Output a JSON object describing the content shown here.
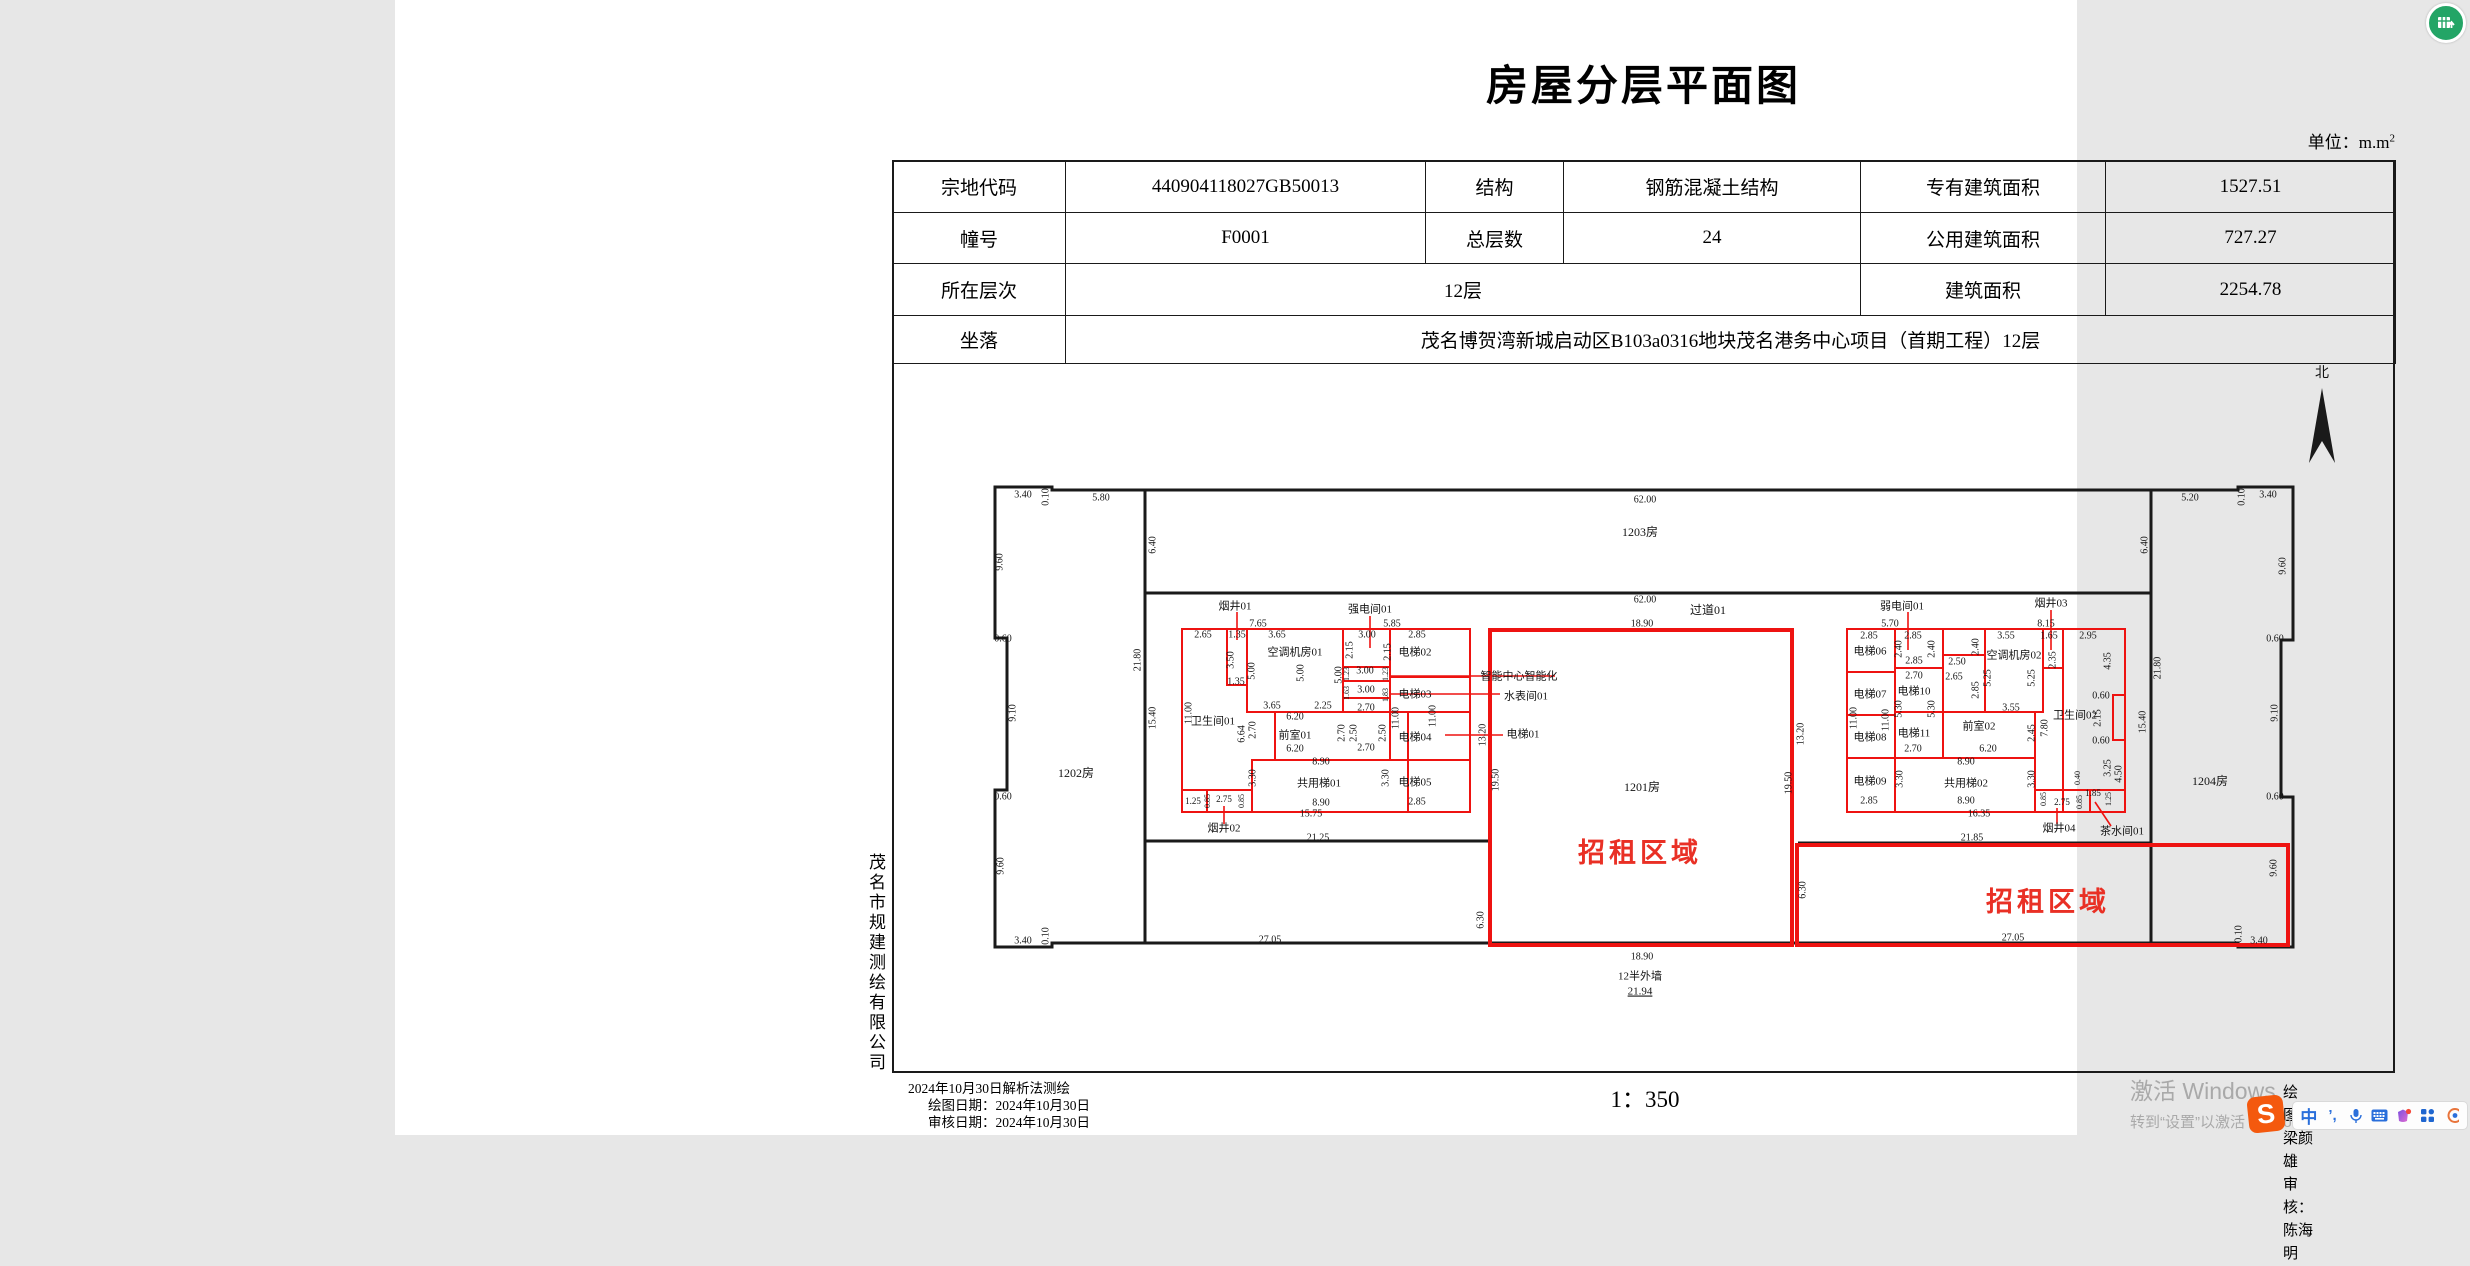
{
  "page": {
    "title": "房屋分层平面图",
    "unit_prefix": "单位：m.m",
    "unit_sup": "2"
  },
  "info_table": {
    "r1c1": "宗地代码",
    "r1c2": "440904118027GB50013",
    "r1c3": "结构",
    "r1c4": "钢筋混凝土结构",
    "r1c5": "专有建筑面积",
    "r1c6": "1527.51",
    "r2c1": "幢号",
    "r2c2": "F0001",
    "r2c3": "总层数",
    "r2c4": "24",
    "r2c5": "公用建筑面积",
    "r2c6": "727.27",
    "r3c1": "所在层次",
    "r3c2": "12层",
    "r3c5": "建筑面积",
    "r3c6": "2254.78",
    "r4c1": "坐落",
    "r4c2": "茂名博贺湾新城启动区B103a0316地块茂名港务中心项目（首期工程）12层"
  },
  "company": "茂名市规建测绘有限公司",
  "footer": {
    "line1": "2024年10月30日解析法测绘",
    "line2": "绘图日期：2024年10月30日",
    "line3": "审核日期：2024年10月30日",
    "scale": "1：350",
    "drafter": "绘图：梁颜雄",
    "checker": "审核：陈海明"
  },
  "watermark": {
    "line1": "激活 Windows",
    "line2": "转到“设置”以激活 Windows。"
  },
  "ime": {
    "sogou": "S",
    "mode": "中",
    "punct": "’,"
  },
  "plan": {
    "colors": {
      "wall": "#1a1a1a",
      "red": "#ee1311",
      "text": "#141414",
      "red_text": "#e93025"
    },
    "north_label": "北",
    "north_arrow_points": "1927,388 1914,463 1927,441 1940,463",
    "north_label_pos": [
      1927,
      377
    ],
    "walls": [
      "M657,490 L657,487 L600,487 L600,638 L612,638 L612,790 L600,790 L600,947 L657,947 L657,943 L1843,943 L1843,947 L1898,947 L1898,797 L1886,797 L1886,640 L1898,640 L1898,487 L1843,487 L1843,490 Z",
      "M750,490 L750,943",
      "M1756,490 L1756,943",
      "M750,593 L1756,593",
      "M750,841 L1093,841",
      "M1403,843 L1756,843"
    ],
    "black_lines": [
      [
        995,
        677,
        1075,
        677
      ],
      [
        1013,
        760,
        1075,
        760
      ],
      [
        1452,
        672,
        1500,
        672
      ],
      [
        1452,
        715,
        1500,
        715
      ],
      [
        1452,
        758,
        1500,
        758
      ],
      [
        1500,
        712,
        1548,
        712
      ]
    ],
    "red_rects": [
      {
        "x": 787,
        "y": 629,
        "w": 288,
        "h": 183
      },
      {
        "x": 832,
        "y": 629,
        "w": 20,
        "h": 56
      },
      {
        "x": 852,
        "y": 629,
        "w": 96,
        "h": 83
      },
      {
        "x": 948,
        "y": 629,
        "w": 47,
        "h": 38
      },
      {
        "x": 948,
        "y": 667,
        "w": 47,
        "h": 14
      },
      {
        "x": 948,
        "y": 681,
        "w": 47,
        "h": 17
      },
      {
        "x": 995,
        "y": 629,
        "w": 80,
        "h": 48
      },
      {
        "x": 995,
        "y": 677,
        "w": 80,
        "h": 35
      },
      {
        "x": 995,
        "y": 712,
        "w": 80,
        "h": 48
      },
      {
        "x": 880,
        "y": 712,
        "w": 133,
        "h": 48
      },
      {
        "x": 857,
        "y": 760,
        "w": 156,
        "h": 52
      },
      {
        "x": 1013,
        "y": 760,
        "w": 62,
        "h": 52
      },
      {
        "x": 787,
        "y": 790,
        "w": 25,
        "h": 22
      },
      {
        "x": 812,
        "y": 790,
        "w": 45,
        "h": 22
      },
      {
        "x": 1452,
        "y": 629,
        "w": 278,
        "h": 183
      },
      {
        "x": 1452,
        "y": 629,
        "w": 48,
        "h": 43
      },
      {
        "x": 1452,
        "y": 672,
        "w": 48,
        "h": 43
      },
      {
        "x": 1452,
        "y": 715,
        "w": 48,
        "h": 43
      },
      {
        "x": 1452,
        "y": 758,
        "w": 48,
        "h": 54
      },
      {
        "x": 1500,
        "y": 629,
        "w": 48,
        "h": 39
      },
      {
        "x": 1500,
        "y": 668,
        "w": 48,
        "h": 44
      },
      {
        "x": 1500,
        "y": 712,
        "w": 48,
        "h": 46
      },
      {
        "x": 1548,
        "y": 655,
        "w": 42,
        "h": 57
      },
      {
        "x": 1590,
        "y": 629,
        "w": 58,
        "h": 83
      },
      {
        "x": 1648,
        "y": 629,
        "w": 20,
        "h": 39
      },
      {
        "x": 1548,
        "y": 712,
        "w": 92,
        "h": 46
      },
      {
        "x": 1500,
        "y": 758,
        "w": 140,
        "h": 54
      },
      {
        "x": 1640,
        "y": 790,
        "w": 55,
        "h": 22
      },
      {
        "x": 1695,
        "y": 790,
        "w": 35,
        "h": 22
      },
      {
        "x": 1095,
        "y": 630,
        "w": 302,
        "h": 315,
        "thick": 1
      },
      {
        "x": 1402,
        "y": 845,
        "w": 491,
        "h": 100,
        "thick": 1
      }
    ],
    "red_paths": [
      "M1668,629 L1730,629 L1730,695 L1718,695 L1718,740 L1730,740 L1730,812 L1668,812 Z"
    ],
    "red_lines": [
      [
        842,
        612,
        842,
        640
      ],
      [
        975,
        616,
        975,
        648
      ],
      [
        1513,
        612,
        1513,
        650
      ],
      [
        1656,
        610,
        1656,
        650
      ],
      [
        829,
        824,
        829,
        806
      ],
      [
        1662,
        824,
        1662,
        808
      ],
      [
        1716,
        826,
        1700,
        802
      ],
      [
        995,
        676,
        1160,
        676
      ],
      [
        995,
        694,
        1105,
        694
      ],
      [
        1050,
        735,
        1108,
        735
      ]
    ],
    "labels": [
      {
        "t": "3.40",
        "x": 628,
        "y": 495
      },
      {
        "t": "0.10",
        "x": 651,
        "y": 497,
        "v": 1
      },
      {
        "t": "5.80",
        "x": 706,
        "y": 498
      },
      {
        "t": "62.00",
        "x": 1250,
        "y": 500
      },
      {
        "t": "5.20",
        "x": 1795,
        "y": 498
      },
      {
        "t": "0.10",
        "x": 1847,
        "y": 497,
        "v": 1
      },
      {
        "t": "3.40",
        "x": 1873,
        "y": 495
      },
      {
        "t": "6.40",
        "x": 758,
        "y": 545,
        "v": 1
      },
      {
        "t": "6.40",
        "x": 1750,
        "y": 545,
        "v": 1
      },
      {
        "t": "1203房",
        "x": 1245,
        "y": 533,
        "s": 12
      },
      {
        "t": "62.00",
        "x": 1250,
        "y": 600
      },
      {
        "t": "过道01",
        "x": 1313,
        "y": 611,
        "s": 12
      },
      {
        "t": "18.90",
        "x": 1247,
        "y": 624
      },
      {
        "t": "9.60",
        "x": 605,
        "y": 562,
        "v": 1
      },
      {
        "t": "0.60",
        "x": 608,
        "y": 639
      },
      {
        "t": "9.10",
        "x": 618,
        "y": 713,
        "v": 1
      },
      {
        "t": "0.60",
        "x": 608,
        "y": 797
      },
      {
        "t": "9.60",
        "x": 606,
        "y": 866,
        "v": 1
      },
      {
        "t": "9.60",
        "x": 1888,
        "y": 566,
        "v": 1
      },
      {
        "t": "0.60",
        "x": 1880,
        "y": 639
      },
      {
        "t": "9.10",
        "x": 1880,
        "y": 713,
        "v": 1
      },
      {
        "t": "0.60",
        "x": 1880,
        "y": 797
      },
      {
        "t": "9.60",
        "x": 1879,
        "y": 868,
        "v": 1
      },
      {
        "t": "21.80",
        "x": 743,
        "y": 660,
        "v": 1
      },
      {
        "t": "15.40",
        "x": 758,
        "y": 718,
        "v": 1
      },
      {
        "t": "21.80",
        "x": 1763,
        "y": 668,
        "v": 1
      },
      {
        "t": "15.40",
        "x": 1748,
        "y": 722,
        "v": 1
      },
      {
        "t": "1202房",
        "x": 681,
        "y": 774,
        "s": 12
      },
      {
        "t": "1204房",
        "x": 1815,
        "y": 782,
        "s": 12
      },
      {
        "t": "3.40",
        "x": 628,
        "y": 941
      },
      {
        "t": "0.10",
        "x": 651,
        "y": 936,
        "v": 1
      },
      {
        "t": "0.10",
        "x": 1844,
        "y": 934,
        "v": 1
      },
      {
        "t": "3.40",
        "x": 1864,
        "y": 941
      },
      {
        "t": "27.05",
        "x": 875,
        "y": 940
      },
      {
        "t": "18.90",
        "x": 1247,
        "y": 957
      },
      {
        "t": "27.05",
        "x": 1618,
        "y": 938
      },
      {
        "t": "12半外墙",
        "x": 1245,
        "y": 977,
        "s": 11
      },
      {
        "t": "21.94",
        "x": 1245,
        "y": 992,
        "s": 11,
        "u": 1
      },
      {
        "t": "6.30",
        "x": 1086,
        "y": 920,
        "v": 1
      },
      {
        "t": "6.30",
        "x": 1408,
        "y": 890,
        "v": 1
      },
      {
        "t": "19.50",
        "x": 1101,
        "y": 780,
        "v": 1
      },
      {
        "t": "19.50",
        "x": 1394,
        "y": 783,
        "v": 1
      },
      {
        "t": "13.20",
        "x": 1088,
        "y": 735,
        "v": 1
      },
      {
        "t": "13.20",
        "x": 1406,
        "y": 734,
        "v": 1
      },
      {
        "t": "1201房",
        "x": 1247,
        "y": 788,
        "s": 12
      },
      {
        "t": "招租区域",
        "x": 1245,
        "y": 856,
        "s": 27,
        "c": 1,
        "b": 1
      },
      {
        "t": "招租区域",
        "x": 1653,
        "y": 905,
        "s": 27,
        "c": 1,
        "b": 1
      },
      {
        "t": "21.25",
        "x": 923,
        "y": 838
      },
      {
        "t": "21.85",
        "x": 1577,
        "y": 838
      },
      {
        "t": "烟井01",
        "x": 840,
        "y": 607,
        "s": 11
      },
      {
        "t": "7.65",
        "x": 863,
        "y": 624
      },
      {
        "t": "强电间01",
        "x": 975,
        "y": 610,
        "s": 11
      },
      {
        "t": "5.85",
        "x": 997,
        "y": 624
      },
      {
        "t": "2.65",
        "x": 808,
        "y": 635
      },
      {
        "t": "1.35",
        "x": 842,
        "y": 635
      },
      {
        "t": "3.65",
        "x": 882,
        "y": 635
      },
      {
        "t": "3.00",
        "x": 972,
        "y": 635
      },
      {
        "t": "2.85",
        "x": 1022,
        "y": 635
      },
      {
        "t": "空调机房01",
        "x": 900,
        "y": 653,
        "s": 11
      },
      {
        "t": "电梯02",
        "x": 1020,
        "y": 653,
        "s": 11
      },
      {
        "t": "2.15",
        "x": 955,
        "y": 650,
        "v": 1
      },
      {
        "t": "2.15",
        "x": 993,
        "y": 652,
        "v": 1
      },
      {
        "t": "5.00",
        "x": 857,
        "y": 671,
        "v": 1
      },
      {
        "t": "5.00",
        "x": 906,
        "y": 673,
        "v": 1
      },
      {
        "t": "5.00",
        "x": 944,
        "y": 675,
        "v": 1
      },
      {
        "t": "3.50",
        "x": 836,
        "y": 660,
        "v": 1
      },
      {
        "t": "1.35",
        "x": 841,
        "y": 682
      },
      {
        "t": "1.23",
        "x": 952,
        "y": 674,
        "v": 1,
        "s": 8
      },
      {
        "t": "3.00",
        "x": 970,
        "y": 671
      },
      {
        "t": "1.23",
        "x": 991,
        "y": 674,
        "v": 1,
        "s": 8
      },
      {
        "t": "1.63",
        "x": 952,
        "y": 693,
        "v": 1,
        "s": 8
      },
      {
        "t": "3.00",
        "x": 971,
        "y": 690
      },
      {
        "t": "1.83",
        "x": 991,
        "y": 695,
        "v": 1,
        "s": 8
      },
      {
        "t": "2.70",
        "x": 971,
        "y": 708
      },
      {
        "t": "11.00",
        "x": 1001,
        "y": 718,
        "v": 1
      },
      {
        "t": "11.00",
        "x": 1038,
        "y": 716,
        "v": 1
      },
      {
        "t": "电梯03",
        "x": 1020,
        "y": 695,
        "s": 11
      },
      {
        "t": "电梯04",
        "x": 1020,
        "y": 738,
        "s": 11
      },
      {
        "t": "电梯05",
        "x": 1020,
        "y": 783,
        "s": 11
      },
      {
        "t": "2.85",
        "x": 1022,
        "y": 802
      },
      {
        "t": "卫生间01",
        "x": 818,
        "y": 722,
        "s": 11
      },
      {
        "t": "11.00",
        "x": 794,
        "y": 713,
        "v": 1
      },
      {
        "t": "6.64",
        "x": 847,
        "y": 734,
        "v": 1
      },
      {
        "t": "3.65",
        "x": 877,
        "y": 706
      },
      {
        "t": "2.25",
        "x": 928,
        "y": 706
      },
      {
        "t": "6.20",
        "x": 900,
        "y": 717
      },
      {
        "t": "前室01",
        "x": 900,
        "y": 736,
        "s": 11
      },
      {
        "t": "2.70",
        "x": 858,
        "y": 730,
        "v": 1
      },
      {
        "t": "2.70",
        "x": 947,
        "y": 733,
        "v": 1
      },
      {
        "t": "2.50",
        "x": 959,
        "y": 733,
        "v": 1
      },
      {
        "t": "2.50",
        "x": 988,
        "y": 733,
        "v": 1
      },
      {
        "t": "2.70",
        "x": 971,
        "y": 748
      },
      {
        "t": "6.20",
        "x": 900,
        "y": 749
      },
      {
        "t": "8.90",
        "x": 926,
        "y": 762
      },
      {
        "t": "3.30",
        "x": 858,
        "y": 778,
        "v": 1
      },
      {
        "t": "3.30",
        "x": 991,
        "y": 778,
        "v": 1
      },
      {
        "t": "共用梯01",
        "x": 924,
        "y": 784,
        "s": 11
      },
      {
        "t": "8.90",
        "x": 926,
        "y": 803
      },
      {
        "t": "15.75",
        "x": 916,
        "y": 814
      },
      {
        "t": "1.25",
        "x": 798,
        "y": 802,
        "s": 9
      },
      {
        "t": "2.75",
        "x": 829,
        "y": 800,
        "s": 9
      },
      {
        "t": "0.85",
        "x": 813,
        "y": 801,
        "v": 1,
        "s": 8
      },
      {
        "t": "0.85",
        "x": 847,
        "y": 801,
        "v": 1,
        "s": 8
      },
      {
        "t": "烟井02",
        "x": 829,
        "y": 829,
        "s": 11
      },
      {
        "t": "智能中心智能化",
        "x": 1124,
        "y": 677,
        "s": 11
      },
      {
        "t": "水表间01",
        "x": 1131,
        "y": 697,
        "s": 11
      },
      {
        "t": "电梯01",
        "x": 1128,
        "y": 735,
        "s": 11
      },
      {
        "t": "弱电间01",
        "x": 1507,
        "y": 607,
        "s": 11
      },
      {
        "t": "5.70",
        "x": 1495,
        "y": 624
      },
      {
        "t": "烟井03",
        "x": 1656,
        "y": 604,
        "s": 11
      },
      {
        "t": "8.15",
        "x": 1651,
        "y": 624
      },
      {
        "t": "2.85",
        "x": 1474,
        "y": 636
      },
      {
        "t": "2.85",
        "x": 1518,
        "y": 636
      },
      {
        "t": "3.55",
        "x": 1611,
        "y": 636
      },
      {
        "t": "1.65",
        "x": 1654,
        "y": 636
      },
      {
        "t": "2.95",
        "x": 1693,
        "y": 636
      },
      {
        "t": "电梯06",
        "x": 1475,
        "y": 652,
        "s": 11
      },
      {
        "t": "2.40",
        "x": 1504,
        "y": 649,
        "v": 1
      },
      {
        "t": "2.40",
        "x": 1537,
        "y": 649,
        "v": 1
      },
      {
        "t": "2.85",
        "x": 1519,
        "y": 661
      },
      {
        "t": "2.50",
        "x": 1562,
        "y": 662
      },
      {
        "t": "2.65",
        "x": 1559,
        "y": 677
      },
      {
        "t": "2.40",
        "x": 1581,
        "y": 647,
        "v": 1
      },
      {
        "t": "2.85",
        "x": 1581,
        "y": 690,
        "v": 1
      },
      {
        "t": "空调机房02",
        "x": 1619,
        "y": 656,
        "s": 11
      },
      {
        "t": "5.25",
        "x": 1593,
        "y": 678,
        "v": 1
      },
      {
        "t": "5.25",
        "x": 1637,
        "y": 678,
        "v": 1
      },
      {
        "t": "2.35",
        "x": 1658,
        "y": 660,
        "v": 1
      },
      {
        "t": "4.35",
        "x": 1713,
        "y": 661,
        "v": 1
      },
      {
        "t": "电梯07",
        "x": 1475,
        "y": 695,
        "s": 11
      },
      {
        "t": "2.70",
        "x": 1519,
        "y": 676
      },
      {
        "t": "电梯10",
        "x": 1519,
        "y": 692,
        "s": 11
      },
      {
        "t": "5.30",
        "x": 1504,
        "y": 709,
        "v": 1
      },
      {
        "t": "5.30",
        "x": 1537,
        "y": 709,
        "v": 1
      },
      {
        "t": "11.00",
        "x": 1459,
        "y": 718,
        "v": 1
      },
      {
        "t": "11.00",
        "x": 1491,
        "y": 720,
        "v": 1
      },
      {
        "t": "0.60",
        "x": 1706,
        "y": 696
      },
      {
        "t": "卫生间02",
        "x": 1680,
        "y": 716,
        "s": 11
      },
      {
        "t": "2.15",
        "x": 1703,
        "y": 718,
        "v": 1
      },
      {
        "t": "0.60",
        "x": 1706,
        "y": 741
      },
      {
        "t": "电梯08",
        "x": 1475,
        "y": 738,
        "s": 11
      },
      {
        "t": "电梯11",
        "x": 1519,
        "y": 734,
        "s": 11
      },
      {
        "t": "2.70",
        "x": 1518,
        "y": 749
      },
      {
        "t": "前室02",
        "x": 1584,
        "y": 727,
        "s": 11
      },
      {
        "t": "2.45",
        "x": 1637,
        "y": 733,
        "v": 1
      },
      {
        "t": "7.80",
        "x": 1650,
        "y": 728,
        "v": 1
      },
      {
        "t": "6.20",
        "x": 1593,
        "y": 749
      },
      {
        "t": "3.55",
        "x": 1616,
        "y": 708
      },
      {
        "t": "3.25",
        "x": 1713,
        "y": 768,
        "v": 1
      },
      {
        "t": "4.50",
        "x": 1724,
        "y": 774,
        "v": 1
      },
      {
        "t": "8.90",
        "x": 1571,
        "y": 762
      },
      {
        "t": "3.30",
        "x": 1505,
        "y": 779,
        "v": 1
      },
      {
        "t": "3.30",
        "x": 1637,
        "y": 779,
        "v": 1
      },
      {
        "t": "共用梯02",
        "x": 1571,
        "y": 784,
        "s": 11
      },
      {
        "t": "8.90",
        "x": 1571,
        "y": 801
      },
      {
        "t": "16.35",
        "x": 1584,
        "y": 814
      },
      {
        "t": "电梯09",
        "x": 1475,
        "y": 782,
        "s": 11
      },
      {
        "t": "2.85",
        "x": 1474,
        "y": 801
      },
      {
        "t": "0.40",
        "x": 1683,
        "y": 778,
        "v": 1,
        "s": 8
      },
      {
        "t": "0.85",
        "x": 1649,
        "y": 799,
        "v": 1,
        "s": 8
      },
      {
        "t": "2.75",
        "x": 1667,
        "y": 803,
        "s": 9
      },
      {
        "t": "0.85",
        "x": 1685,
        "y": 802,
        "v": 1,
        "s": 8
      },
      {
        "t": "1.85",
        "x": 1698,
        "y": 794,
        "s": 9
      },
      {
        "t": "1.25",
        "x": 1714,
        "y": 799,
        "v": 1,
        "s": 8
      },
      {
        "t": "烟井04",
        "x": 1664,
        "y": 829,
        "s": 11
      },
      {
        "t": "茶水间01",
        "x": 1727,
        "y": 832,
        "s": 11
      }
    ]
  }
}
